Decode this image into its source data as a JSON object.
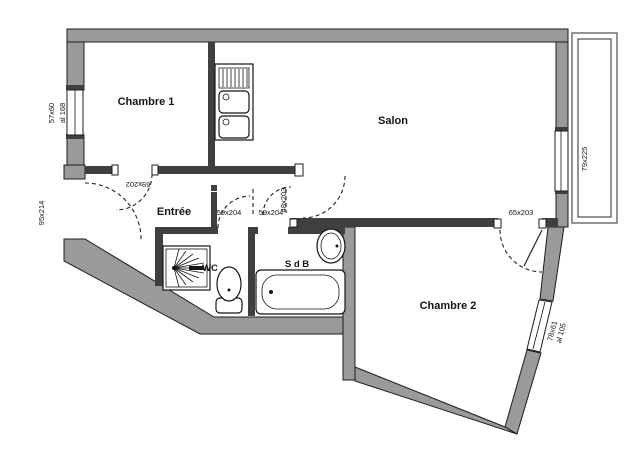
{
  "plan": {
    "rooms": {
      "chambre1": "Chambre 1",
      "salon": "Salon",
      "entree": "Entrée",
      "wc": "WC",
      "sdb": "S d B",
      "chambre2": "Chambre 2"
    },
    "dimensions": {
      "left_window_size": "57x60",
      "left_window_sill": "al 168",
      "entrance_door": "95x214",
      "chambre1_door": "69x202",
      "wc_door": "59x204",
      "sdb_door": "59x204",
      "hall_salon_door": "48x203",
      "chambre2_door": "65x203",
      "balcony_window": "79x225",
      "chambre2_window_size": "78x61",
      "chambre2_window_sill": "al 105"
    },
    "colors": {
      "wall_gray": "#9a9a9a",
      "interior_wall": "#3f3f3f",
      "line": "#1c1c1c",
      "background": "#ffffff"
    }
  }
}
